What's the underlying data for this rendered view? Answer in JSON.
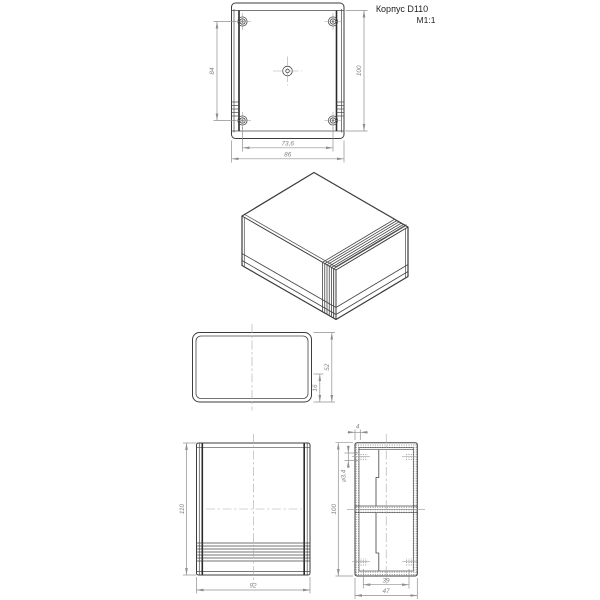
{
  "title": {
    "name": "Корпус D110",
    "scale": "М1:1"
  },
  "top_view": {
    "screw_spacing_v": "84",
    "body_height": "100",
    "screw_spacing_h": "73,6",
    "body_width": "86"
  },
  "end_view": {
    "depth": "52",
    "lip_height": "16"
  },
  "front_view": {
    "height": "110",
    "width": "92"
  },
  "section_view": {
    "wall_thickness": "4",
    "height": "100",
    "boss_hole_dia": "⌀3,4",
    "inner_width": "39",
    "outer_depth": "47"
  },
  "colors": {
    "line": "#3d3d3d",
    "dimension": "#8f8f8f",
    "background": "#ffffff"
  }
}
